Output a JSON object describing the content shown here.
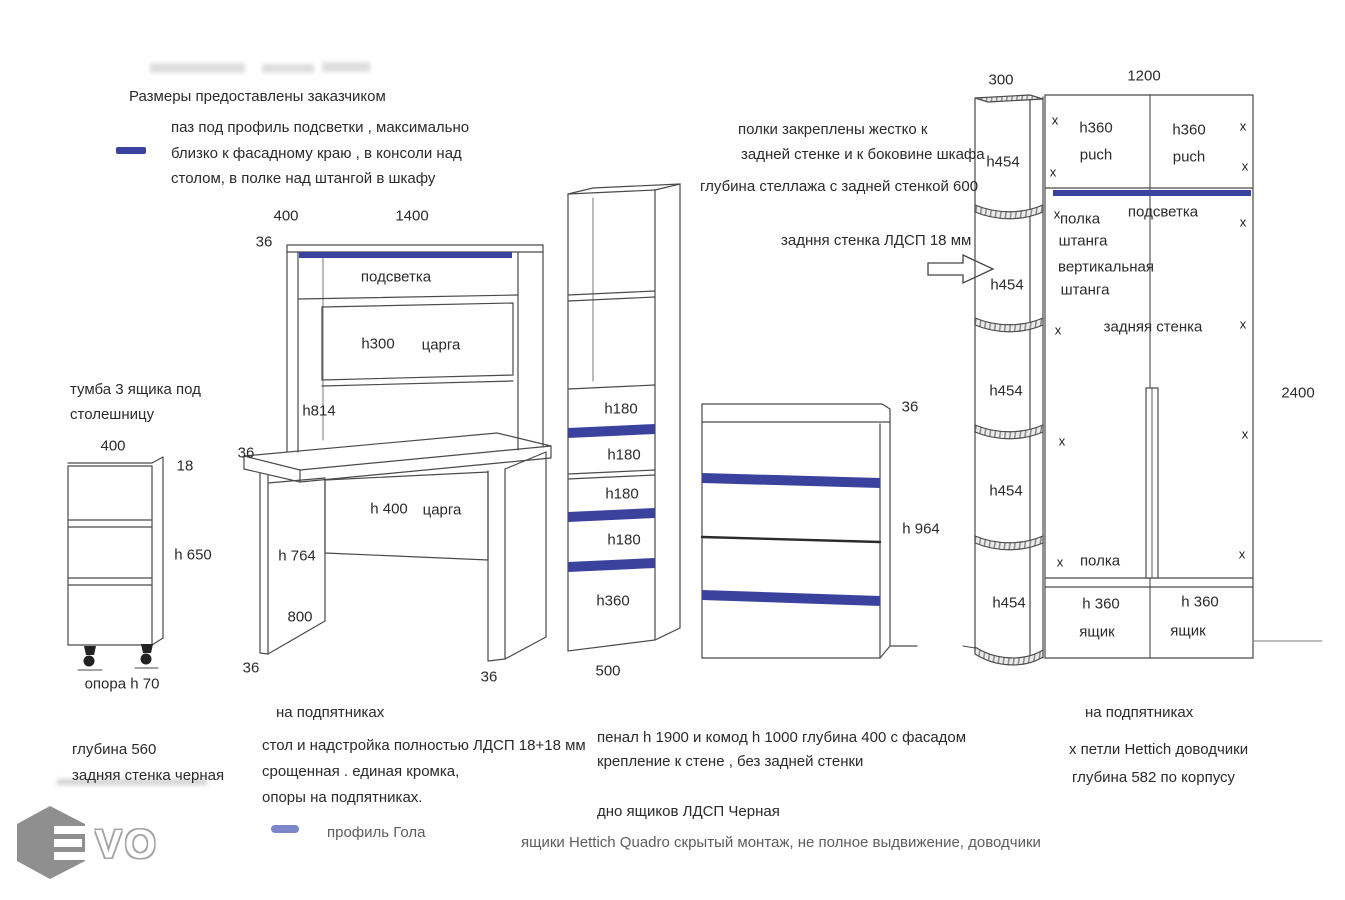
{
  "palette": {
    "accent": "#3b429d",
    "gola": "#7d86c8"
  },
  "header": {
    "note": "Размеры предоставлены заказчиком",
    "legend_groove": "паз под профиль подсветки , максимально\nблизко к фасадному краю  , в консоли над\nстолом, в полке над штангой в шкафу"
  },
  "dims": {
    "t36": "36",
    "x": "x"
  },
  "tumba": {
    "title": "тумба 3 ящика под\nстолешницу",
    "w400": "400",
    "t18": "18",
    "h650": "h 650",
    "support": "опора h 70",
    "note": "глубина  560\nзадняя стенка черная"
  },
  "desk": {
    "w400": "400",
    "w1400": "1400",
    "podsvetka": "подсветка",
    "h300": "h300",
    "tsarga": "царга",
    "h814": "h814",
    "h400": "h 400",
    "tsarga2": "царга",
    "h764": "h 764",
    "d800": "800",
    "feet": "на подпятниках",
    "note": "стол и надстройка полностью ЛДСП 18+18 мм\nсрощенная . единая  кромка,\nопоры на подпятниках."
  },
  "gola": {
    "label": "профиль Гола"
  },
  "penal": {
    "d1": "h180",
    "d2": "h180",
    "d3": "h180",
    "d4": "h180",
    "d5": "h360",
    "w500": "500"
  },
  "komod": {
    "h964": "h 964",
    "note": "пенал h 1900 и комод h 1000  глубина  400 с фасадом\nкрепление к стене  , без задней стенки",
    "bottom_note": "дно ящиков ЛДСП  Черная",
    "hw_note": "ящики Hettich Quadro скрытый монтаж, не полное выдвижение, доводчики"
  },
  "wardrobe": {
    "note1": "полки закреплены жестко к",
    "note2": "задней стенке и к боковине шкафа",
    "note3": "глубина стеллажа с задней стенкой  600",
    "note_back": "задння стенка ЛДСП 18 мм",
    "w300": "300",
    "w1200": "1200",
    "h2400": "2400",
    "h454": "h454",
    "h360": "h360",
    "puch": "puch",
    "podsvetka": "подсветка",
    "polka": "полка",
    "shtanga": "штанга",
    "vertikalnaya": "вертикальная",
    "back_wall": "задняя стенка",
    "polka2": "полка",
    "h360d": "h 360",
    "yashik": "ящик",
    "feet": "на подпятниках",
    "hinges": "х петли Hettich доводчики",
    "depth": "глубина 582 по корпусу"
  },
  "logo": {
    "vo": "VO"
  }
}
